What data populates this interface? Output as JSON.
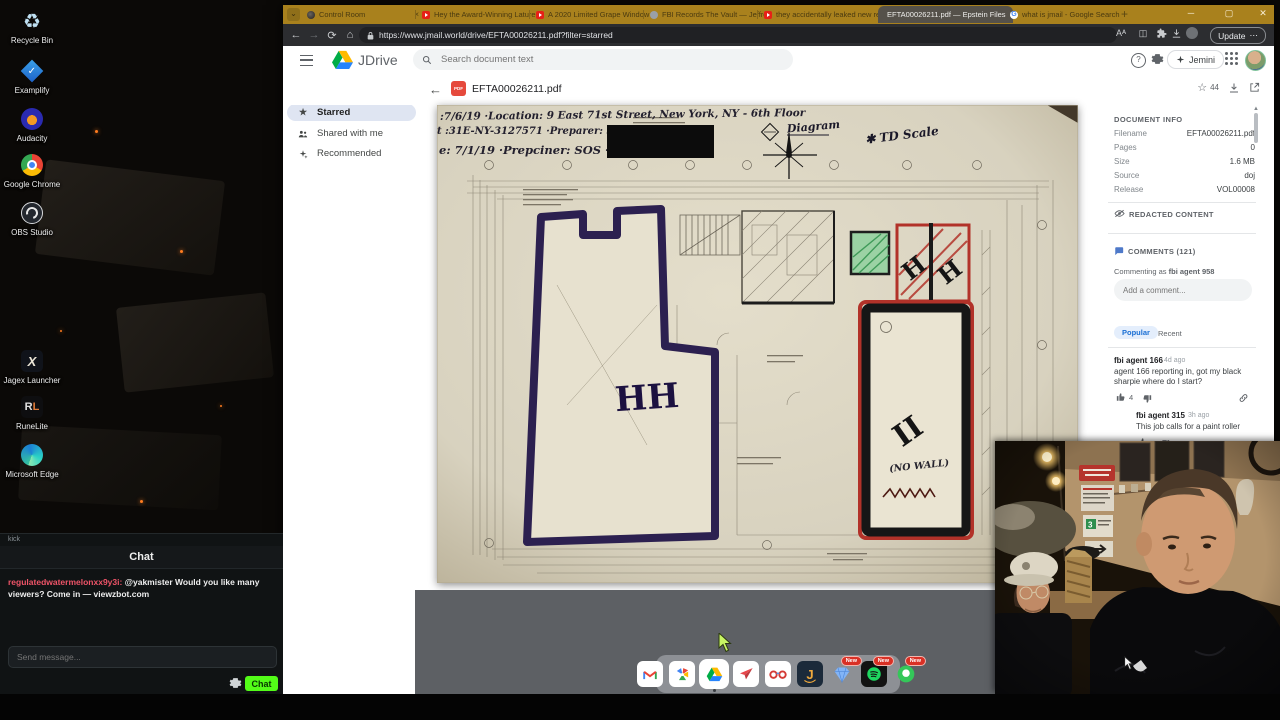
{
  "desktop": {
    "icons": [
      {
        "label": "Recycle Bin"
      },
      {
        "label": "Examplify"
      },
      {
        "label": "Audacity"
      },
      {
        "label": "Google Chrome"
      },
      {
        "label": "OBS Studio"
      },
      {
        "label": "Jagex Launcher"
      },
      {
        "label": "RuneLite"
      },
      {
        "label": "Microsoft Edge"
      }
    ]
  },
  "chat": {
    "window_title": "kick",
    "header": "Chat",
    "message": {
      "username": "regulatedwatermelonxx9y3i:",
      "text": "@yakmister Would you like many viewers? Come in — viewzbot.com"
    },
    "input_placeholder": "Send message...",
    "send_button": "Chat"
  },
  "browser": {
    "tabs": [
      {
        "title": "Control Room"
      },
      {
        "title": "Hey the Award-Winning Lature, Y"
      },
      {
        "title": "A 2020 Limited Grape Window"
      },
      {
        "title": "FBI Records The Vault — Jeffrey"
      },
      {
        "title": "they accidentally leaked new repl"
      },
      {
        "title": "EFTA00026211.pdf — Epstein Files"
      },
      {
        "title": "what is jmail - Google Search"
      }
    ],
    "url": "https://www.jmail.world/drive/EFTA00026211.pdf?filter=starred",
    "update_label": "Update",
    "update_more": "⋯"
  },
  "drive": {
    "brand": "JDrive",
    "search_placeholder": "Search document text",
    "jemini_label": "Jemini",
    "sidebar": [
      {
        "label": "Home"
      },
      {
        "label": "Starred"
      },
      {
        "label": "Shared with me"
      },
      {
        "label": "Recommended"
      }
    ],
    "doc_title": "EFTA00026211.pdf",
    "star_count": "44"
  },
  "pdf": {
    "line1": ":7/6/19   ·Location: 9 East 71st Street, New York, NY - 6th Floor",
    "line2": "t :31E-NY-3127571    ·Preparer: SA",
    "line3": "e: 7/1/19   ·Prepciner: SOS ·",
    "diagram_label": "Diagram",
    "scale_note": "✱ TD Scale",
    "mark_hh": "HH",
    "mark_ii": "II",
    "no_wall": "(NO WALL)"
  },
  "info": {
    "title": "DOCUMENT INFO",
    "fields": [
      {
        "label": "Filename",
        "value": "EFTA00026211.pdf"
      },
      {
        "label": "Pages",
        "value": "0"
      },
      {
        "label": "Size",
        "value": "1.6 MB"
      },
      {
        "label": "Source",
        "value": "doj"
      },
      {
        "label": "Release",
        "value": "VOL00008"
      }
    ],
    "redacted_label": "REDACTED CONTENT",
    "comments_title": "COMMENTS (121)",
    "commenting_as": "Commenting as",
    "commenting_user": "fbi agent 958",
    "add_placeholder": "Add a comment...",
    "tab_popular": "Popular",
    "tab_recent": "Recent",
    "comments": [
      {
        "user": "fbi agent 166",
        "time": "4d ago",
        "text": "agent 166 reporting in, got my black sharpie where do I start?",
        "likes": "4"
      },
      {
        "user": "fbi agent 315",
        "time": "3h ago",
        "text": "This job calls for a paint roller"
      }
    ]
  },
  "dock": {
    "badge_label": "New"
  }
}
